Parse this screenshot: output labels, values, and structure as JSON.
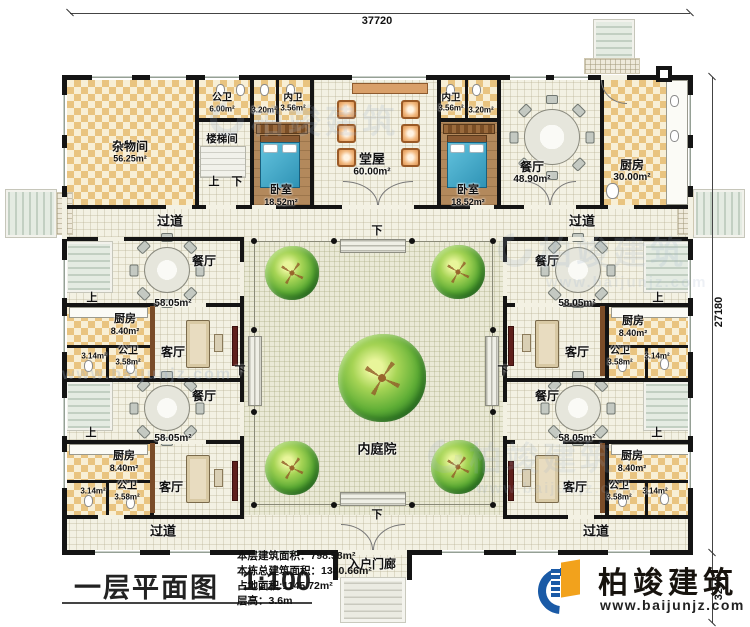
{
  "dimensions": {
    "top": "37720",
    "right_main": "27180",
    "right_lower": "3240"
  },
  "common": {
    "corridor": "过道",
    "up": "上",
    "down": "下"
  },
  "north": {
    "storage": {
      "name": "杂物间",
      "area": "56.25m²"
    },
    "public_wc": {
      "name": "公卫",
      "area": "6.00m²"
    },
    "stair_hall": {
      "name": "楼梯间"
    },
    "small_wc_area": "3.20m²",
    "inner_wc": {
      "name": "内卫",
      "area": "3.56m²"
    },
    "bedroom": {
      "name": "卧室",
      "area": "18.52m²"
    },
    "hall": {
      "name": "堂屋",
      "area": "60.00m²"
    },
    "dining": {
      "name": "餐厅",
      "area": "48.90m²"
    },
    "kitchen": {
      "name": "厨房",
      "area": "30.00m²"
    }
  },
  "wing": {
    "dining": {
      "name": "餐厅",
      "area": "58.05m²"
    },
    "kitchen": {
      "name": "厨房",
      "area": "8.40m²"
    },
    "wc": {
      "name": "公卫",
      "area": "3.58m²"
    },
    "wc_small_area": "3.14m²",
    "living": {
      "name": "客厅"
    }
  },
  "courtyard": {
    "name": "内庭院"
  },
  "porch": {
    "name": "入户门廊"
  },
  "titleblock": {
    "title": "一层平面图",
    "scale": "1:100"
  },
  "stats": {
    "line1": "本层建筑面积：798.58m²",
    "line2": "本栋总建筑面积：1340.66m²",
    "line3": "占地面积:1145.72m²",
    "line4": "层高：3.6m"
  },
  "brand": {
    "name": "柏竣建筑",
    "url": "www.baijunjz.com"
  },
  "watermark": {
    "name": "柏竣建筑",
    "url": "www.baijunjz.com"
  }
}
